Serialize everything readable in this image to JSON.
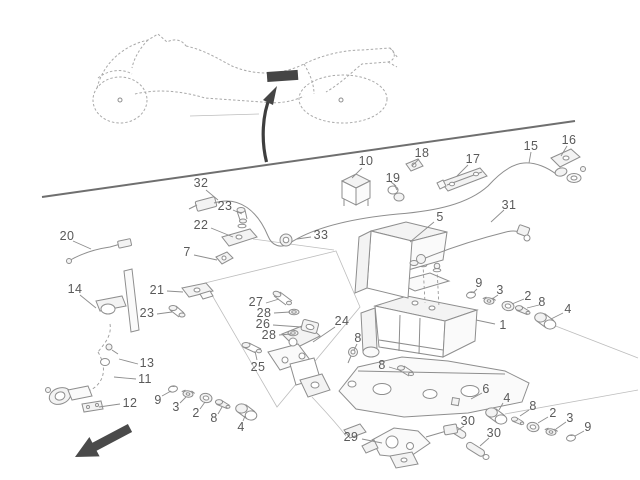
{
  "figure": {
    "kind": "exploded-parts-location-diagram",
    "subject": "Motorcycle ABS hydraulic unit, brake hoses and sensors — parts location drawing",
    "colors": {
      "line": "#8e8e8e",
      "label": "#5a5a5a",
      "accent": "#454545",
      "sketch": "#a9a9a9"
    }
  },
  "icons": {
    "front_direction_arrow": "large solid arrow pointing to lower-left (vehicle front indicator)",
    "location_pointer_arrow": "curved arrow pointing up at highlighted frame location",
    "location_highlight": "solid dark bar on motorcycle tail frame marking the unit position"
  },
  "callouts": [
    {
      "text": "10",
      "x": 366,
      "y": 161,
      "leader": [
        362,
        168,
        352,
        178
      ]
    },
    {
      "text": "32",
      "x": 201,
      "y": 183,
      "leader": [
        206,
        190,
        218,
        200
      ]
    },
    {
      "text": "23",
      "x": 225,
      "y": 206,
      "leader": [
        233,
        210,
        242,
        214
      ]
    },
    {
      "text": "22",
      "x": 201,
      "y": 225,
      "leader": [
        211,
        228,
        233,
        237
      ]
    },
    {
      "text": "33",
      "x": 321,
      "y": 235,
      "leader": [
        311,
        237,
        297,
        239
      ]
    },
    {
      "text": "7",
      "x": 187,
      "y": 252,
      "leader": [
        194,
        255,
        217,
        260
      ]
    },
    {
      "text": "18",
      "x": 422,
      "y": 153,
      "leader": [
        419,
        159,
        412,
        166
      ]
    },
    {
      "text": "17",
      "x": 473,
      "y": 159,
      "leader": [
        468,
        165,
        457,
        176
      ]
    },
    {
      "text": "19",
      "x": 393,
      "y": 178,
      "leader": [
        394,
        184,
        397,
        190
      ]
    },
    {
      "text": "15",
      "x": 531,
      "y": 146,
      "leader": [
        531,
        152,
        529,
        163
      ]
    },
    {
      "text": "16",
      "x": 569,
      "y": 140,
      "leader": [
        567,
        146,
        561,
        156
      ]
    },
    {
      "text": "31",
      "x": 509,
      "y": 205,
      "leader": [
        504,
        210,
        491,
        222
      ]
    },
    {
      "text": "5",
      "x": 440,
      "y": 217,
      "leader": [
        434,
        222,
        410,
        242
      ]
    },
    {
      "text": "20",
      "x": 67,
      "y": 236,
      "leader": [
        73,
        241,
        91,
        249
      ]
    },
    {
      "text": "14",
      "x": 75,
      "y": 289,
      "leader": [
        80,
        295,
        96,
        308
      ]
    },
    {
      "text": "21",
      "x": 157,
      "y": 290,
      "leader": [
        167,
        291,
        183,
        292
      ]
    },
    {
      "text": "23",
      "x": 147,
      "y": 313,
      "leader": [
        157,
        314,
        172,
        312
      ]
    },
    {
      "text": "27",
      "x": 256,
      "y": 302,
      "leader": [
        266,
        303,
        279,
        299
      ]
    },
    {
      "text": "28",
      "x": 264,
      "y": 313,
      "leader": [
        274,
        313,
        290,
        312
      ]
    },
    {
      "text": "26",
      "x": 263,
      "y": 324,
      "leader": [
        273,
        325,
        301,
        327
      ]
    },
    {
      "text": "28",
      "x": 269,
      "y": 335,
      "leader": [
        279,
        335,
        291,
        334
      ]
    },
    {
      "text": "25",
      "x": 258,
      "y": 367,
      "leader": [
        257,
        360,
        255,
        351
      ]
    },
    {
      "text": "24",
      "x": 342,
      "y": 321,
      "leader": [
        335,
        327,
        313,
        342
      ]
    },
    {
      "text": "8",
      "x": 358,
      "y": 338,
      "leader": [
        357,
        344,
        354,
        350
      ]
    },
    {
      "text": "8",
      "x": 382,
      "y": 365,
      "leader": [
        389,
        367,
        399,
        370
      ]
    },
    {
      "text": "1",
      "x": 503,
      "y": 325,
      "leader": [
        495,
        324,
        476,
        320
      ]
    },
    {
      "text": "9",
      "x": 479,
      "y": 283,
      "leader": [
        477,
        289,
        473,
        293
      ]
    },
    {
      "text": "3",
      "x": 500,
      "y": 290,
      "leader": [
        498,
        295,
        492,
        299
      ]
    },
    {
      "text": "2",
      "x": 528,
      "y": 296,
      "leader": [
        524,
        299,
        512,
        304
      ]
    },
    {
      "text": "8",
      "x": 542,
      "y": 302,
      "leader": [
        539,
        305,
        527,
        308
      ]
    },
    {
      "text": "4",
      "x": 568,
      "y": 309,
      "leader": [
        563,
        313,
        551,
        319
      ]
    },
    {
      "text": "6",
      "x": 486,
      "y": 389,
      "leader": [
        482,
        393,
        471,
        399
      ]
    },
    {
      "text": "4",
      "x": 507,
      "y": 398,
      "leader": [
        503,
        403,
        499,
        410
      ]
    },
    {
      "text": "8",
      "x": 533,
      "y": 406,
      "leader": [
        529,
        410,
        520,
        416
      ]
    },
    {
      "text": "2",
      "x": 553,
      "y": 413,
      "leader": [
        548,
        417,
        538,
        423
      ]
    },
    {
      "text": "3",
      "x": 570,
      "y": 418,
      "leader": [
        566,
        422,
        556,
        429
      ]
    },
    {
      "text": "9",
      "x": 588,
      "y": 427,
      "leader": [
        584,
        431,
        575,
        436
      ]
    },
    {
      "text": "30",
      "x": 468,
      "y": 421,
      "leader": [
        464,
        426,
        458,
        430
      ]
    },
    {
      "text": "30",
      "x": 494,
      "y": 433,
      "leader": [
        489,
        438,
        480,
        446
      ]
    },
    {
      "text": "29",
      "x": 351,
      "y": 437,
      "leader": [
        362,
        439,
        382,
        443
      ]
    },
    {
      "text": "13",
      "x": 147,
      "y": 363,
      "leader": [
        138,
        364,
        119,
        359
      ]
    },
    {
      "text": "11",
      "x": 145,
      "y": 379,
      "leader": [
        136,
        379,
        114,
        377
      ]
    },
    {
      "text": "12",
      "x": 130,
      "y": 403,
      "leader": [
        120,
        404,
        99,
        407
      ]
    },
    {
      "text": "9",
      "x": 158,
      "y": 400,
      "leader": [
        162,
        396,
        171,
        391
      ]
    },
    {
      "text": "3",
      "x": 176,
      "y": 407,
      "leader": [
        180,
        403,
        186,
        397
      ]
    },
    {
      "text": "2",
      "x": 196,
      "y": 413,
      "leader": [
        200,
        409,
        205,
        402
      ]
    },
    {
      "text": "8",
      "x": 214,
      "y": 418,
      "leader": [
        218,
        414,
        222,
        407
      ]
    },
    {
      "text": "4",
      "x": 241,
      "y": 427,
      "leader": [
        243,
        421,
        245,
        416
      ]
    }
  ]
}
